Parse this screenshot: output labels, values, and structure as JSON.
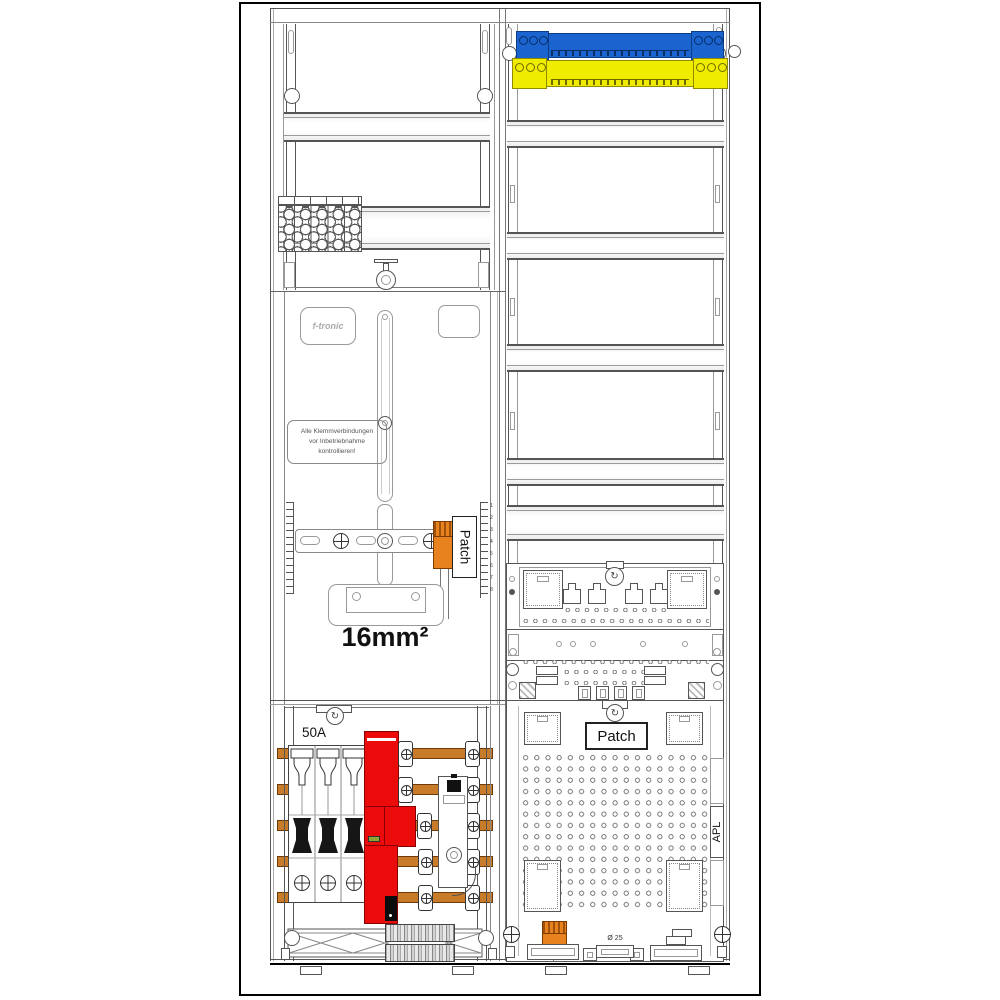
{
  "colors": {
    "busbar_blue": "#1b64cf",
    "busbar_yellow": "#efec00",
    "breaker_red": "#ec0b0b",
    "terminal_orange": "#e8821e",
    "busbar_copper": "#c87c2a",
    "led_green": "#8aa735",
    "outline": "#444444"
  },
  "icons": {
    "seal_screw": "↻"
  },
  "left_column": {
    "meter_panel": {
      "brand_logo": "f-tronic",
      "warning_line1": "Alle Klemmverbindungen",
      "warning_line2": "vor Inbetriebnahme",
      "warning_line3": "kontrollieren!",
      "patch_label": "Patch",
      "wire_size_label": "16mm²",
      "ruler_labels": [
        "1",
        "2",
        "3",
        "4",
        "5",
        "6",
        "7",
        "8"
      ]
    },
    "distribution_panel": {
      "fuse_rating": "50A"
    }
  },
  "right_column": {
    "apl_panel": {
      "patch_label": "Patch",
      "apl_label": "APL",
      "conduit_diameter_label": "Ø 25"
    }
  }
}
